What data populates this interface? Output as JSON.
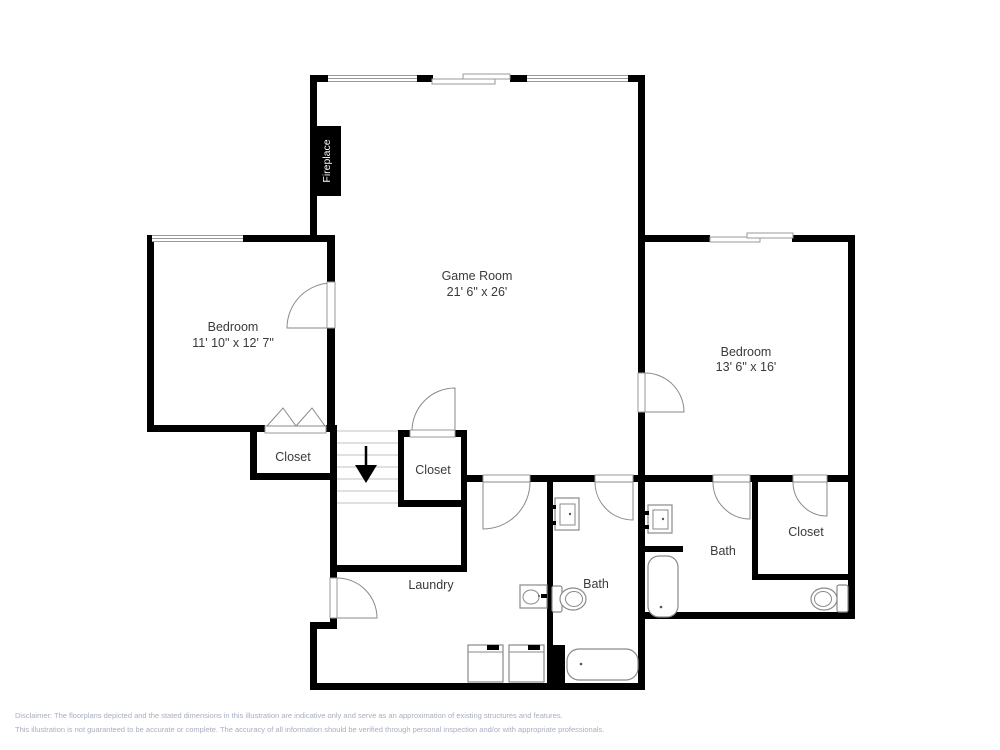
{
  "plan": {
    "fireplace_label": "Fireplace",
    "rooms": {
      "game_room": {
        "name": "Game Room",
        "dims": "21' 6\" x 26'"
      },
      "bedroom_left": {
        "name": "Bedroom",
        "dims": "11' 10\" x 12' 7\""
      },
      "bedroom_right": {
        "name": "Bedroom",
        "dims": "13' 6\" x 16'"
      },
      "closet_left": {
        "name": "Closet"
      },
      "closet_center": {
        "name": "Closet"
      },
      "closet_right": {
        "name": "Closet"
      },
      "laundry": {
        "name": "Laundry"
      },
      "bath_center": {
        "name": "Bath"
      },
      "bath_right": {
        "name": "Bath"
      }
    }
  },
  "disclaimer": {
    "line1": "Disclaimer: The floorplans depicted and the stated dimensions in this illustration are indicative only and serve as an approximation of existing structures and features.",
    "line2": "This illustration is not guaranteed to be accurate or complete. The accuracy of all information should be verified through personal inspection and/or with appropriate professionals."
  },
  "colors": {
    "wall": "#000000",
    "room_label": "#3a3a3a",
    "fixture_outline": "#8a8a8a",
    "window_line": "#9a9a9a",
    "stair_tread": "#c2c2c2",
    "disclaimer_text": "#a9aec1",
    "fireplace_text": "#ffffff"
  }
}
